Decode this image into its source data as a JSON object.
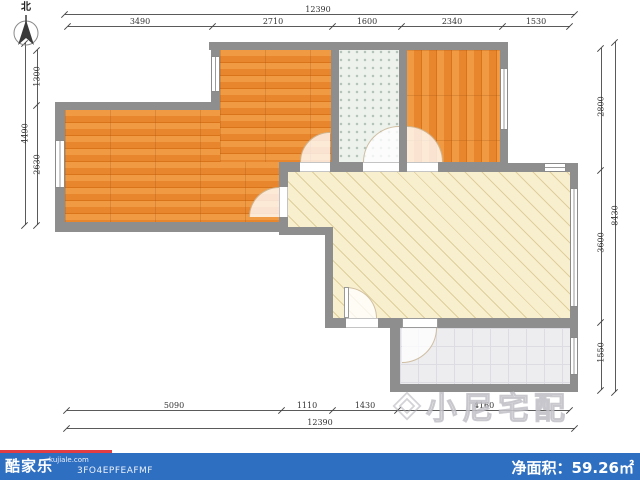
{
  "north": {
    "label": "北"
  },
  "dimensions": {
    "top": {
      "total": "12390",
      "segments": [
        "3490",
        "2710",
        "1600",
        "2340",
        "1530"
      ]
    },
    "bottom": {
      "total": "12390",
      "segments": [
        "5090",
        "1110",
        "1430",
        "4160"
      ]
    },
    "left": {
      "total": "4490",
      "segments": [
        "1300",
        "2630"
      ]
    },
    "right": {
      "total": "8430",
      "segments": [
        "2800",
        "3600",
        "1550"
      ]
    }
  },
  "watermark": {
    "text": "小尼宅配"
  },
  "footer": {
    "brand": "酷家乐",
    "domain": "kujiale.com",
    "code": "3FO4EPFEAFMF",
    "area_label": "净面积：",
    "area_value": "59.26㎡"
  },
  "colors": {
    "wall": "#8e8e8e",
    "wood_floor": "#e8862e",
    "bathroom_tile": "#edf2ed",
    "living_floor": "#f8efcf",
    "balcony_floor": "#ededf0",
    "footer_bar": "#2f6fc1",
    "footer_accent": "#e23c44",
    "dimension_text": "#333333"
  }
}
